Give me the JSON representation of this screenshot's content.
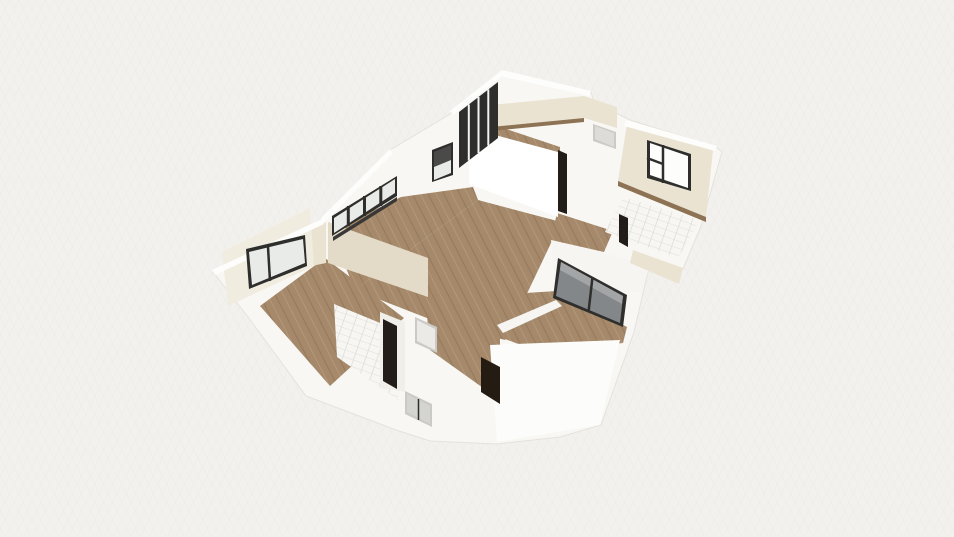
{
  "scene": {
    "canvas": {
      "width": 954,
      "height": 537,
      "view_label": "3d-floor-plan-view"
    },
    "palette": {
      "bg": "#f2f1ee",
      "gridLine": "#e7e6e2",
      "baseWhite": "#f8f7f4",
      "baseEdge": "#e4e2dc",
      "wallLight": "#f6f5f1",
      "wallBright": "#fcfcfa",
      "wallShade": "#f1efe9",
      "blockWhite": "#ffffff",
      "wallTop": "#fdfdfb",
      "cream": "#eae3d2",
      "creamDark": "#e3dbc7",
      "creamPale": "#f0ece0",
      "woodBase": "#a5896a",
      "woodDark": "#967a5d",
      "woodLight": "#b2977a",
      "woodTrim": "#8d7254",
      "tileBase": "#f7f6f3",
      "tileLine": "#d9d6cf",
      "frameDark": "#2e2e2c",
      "mullion": "#f4f4f1",
      "glassDark": "#4a4a48",
      "glassLight": "#e9ebe9",
      "glassWhite": "#fdfdfc",
      "glassMid": "#84878a",
      "glassHi": "#a3a5a7",
      "glassPale": "#d4d4d0",
      "sillDark": "#3a3836",
      "doorBrown": "#241c12",
      "doorDark": "#221d18",
      "doorGray": "#dddcd9",
      "doorGrayFrame": "#cbcac6",
      "doorWhite": "#eceae7"
    },
    "shapes": [
      {
        "name": "building-base",
        "fill": "baseWhite",
        "stroke": "baseEdge",
        "points": "502,71 591,92 594,102 630,120 716,147 722,152 701,226 683,269 652,260 648,272 634,332 601,425 560,437 497,444 430,441 396,430 306,396 248,317 213,272 322,220 330,212 390,150 452,113"
      },
      {
        "name": "room-a-floor",
        "fill": "wood",
        "points": "467,116 560,147 560,156 467,128"
      },
      {
        "name": "living-room-floor-upper",
        "fill": "wood",
        "points": "331,231 401,197 473,187 478,200 355,290"
      },
      {
        "name": "living-room-floor-center",
        "fill": "wood",
        "points": "355,290 478,200 561,222 505,340 432,320"
      },
      {
        "name": "hallway-floor",
        "fill": "wood",
        "points": "557,213 613,231 604,252 551,240"
      },
      {
        "name": "dining-area-floor",
        "fill": "wood",
        "points": "448,298 557,291 627,327 623,343 540,352 448,318"
      },
      {
        "name": "entry-floor",
        "fill": "wood",
        "points": "425,292 500,325 500,400 430,350"
      },
      {
        "name": "bedroom-left-floor",
        "fill": "wood",
        "points": "325,258 404,318 330,386 260,306"
      },
      {
        "name": "bathroom-left-floor",
        "fill": "tile",
        "points": "334,304 397,330 398,400 337,357"
      },
      {
        "name": "bathroom-right-floor",
        "fill": "tile",
        "points": "623,197 700,220 678,258 605,232"
      },
      {
        "name": "partition-entry-dining",
        "fill": "wallLight",
        "points": "497,325 556,300 562,306 503,333"
      },
      {
        "name": "right-wing-wall",
        "fill": "wallLight",
        "points": "551,240 650,265 642,292 556,289"
      },
      {
        "name": "south-wing-wall",
        "fill": "wallBright",
        "points": "490,345 620,340 600,425 497,442"
      },
      {
        "name": "bathroom-left-wall",
        "fill": "wallShade",
        "points": "380,312 405,322 405,392 380,388"
      },
      {
        "name": "closet-block",
        "fill": "blockWhite",
        "points": "469,128 558,152 558,217 469,184"
      },
      {
        "name": "room-a-north-wall",
        "fill": "cream",
        "points": "470,107 584,96 584,118 470,129"
      },
      {
        "name": "room-a-east-wall",
        "fill": "cream",
        "points": "584,96 617,107 617,128 584,118"
      },
      {
        "name": "corridor-wall-left",
        "fill": "creamDark",
        "points": "328,222 428,258 428,297 328,263"
      },
      {
        "name": "left-wing-corner-wall",
        "fill": "cream",
        "points": "300,233 326,222 326,263 302,268"
      },
      {
        "name": "bedroom-left-window-wall",
        "fill": "creamPale",
        "points": "222,252 310,208 314,266 228,306"
      },
      {
        "name": "bedroom-right-north-wall",
        "fill": "cream",
        "points": "627,124 713,150 706,217 618,181"
      },
      {
        "name": "dining-east-wall",
        "fill": "cream",
        "points": "633,250 683,268 679,284 630,263"
      },
      {
        "name": "room-a-wall-base-trim",
        "fill": "woodTrim",
        "points": "470,129 584,118 584,122 470,133"
      },
      {
        "name": "bedroom-right-wall-base-trim",
        "fill": "woodTrim",
        "points": "618,181 706,217 706,222 618,186"
      },
      {
        "name": "wall-top-room-a-west",
        "fill": "wallTop",
        "points": "450,111 502,70 505,74 453,115"
      },
      {
        "name": "wall-top-room-a-north",
        "fill": "wallTop",
        "points": "502,70 591,91 589,96 500,76"
      },
      {
        "name": "wall-top-bedroom-right",
        "fill": "wallTop",
        "points": "626,120 717,146 715,151 624,126"
      },
      {
        "name": "wall-top-left-wing",
        "fill": "wallTop",
        "points": "321,218 390,149 393,153 324,223"
      },
      {
        "name": "wall-top-bedroom-left",
        "fill": "wallTop",
        "points": "212,270 322,219 324,224 215,275"
      },
      {
        "name": "room-a-glazing-frame",
        "fill": "frameDark",
        "points": "459,112 498,82 498,138 459,168"
      },
      {
        "name": "room-a-glazing-mullion-1",
        "line": [
          468.8,
          104.5,
          468.8,
          160.5
        ],
        "w": 2,
        "fill": "mullion"
      },
      {
        "name": "room-a-glazing-mullion-2",
        "line": [
          478.5,
          97,
          478.5,
          153
        ],
        "w": 2,
        "fill": "mullion"
      },
      {
        "name": "room-a-glazing-mullion-3",
        "line": [
          488.3,
          89.5,
          488.3,
          145.5
        ],
        "w": 2,
        "fill": "mullion"
      },
      {
        "name": "west-window-frame",
        "fill": "frameDark",
        "points": "432,150 453,142 453,175 432,182"
      },
      {
        "name": "west-window-glass-upper",
        "fill": "glassDark",
        "points": "434,152 451,145 451,160 434,167"
      },
      {
        "name": "west-window-glass-lower",
        "fill": "glassLight",
        "points": "434,167 451,160 451,173 434,180"
      },
      {
        "name": "strip-windows-frame",
        "fill": "frameDark",
        "points": "332,216 397,176 397,196 332,236"
      },
      {
        "name": "strip-windows-glass",
        "fill": "glassLight",
        "points": "334,218 395,179 395,193 334,233"
      },
      {
        "name": "strip-windows-mullion-1",
        "line": [
          348.3,
          206,
          348.3,
          226
        ],
        "w": 3,
        "fill": "frameDark"
      },
      {
        "name": "strip-windows-mullion-2",
        "line": [
          364.5,
          196,
          364.5,
          216
        ],
        "w": 3,
        "fill": "frameDark"
      },
      {
        "name": "strip-windows-mullion-3",
        "line": [
          380.8,
          186,
          380.8,
          206
        ],
        "w": 3,
        "fill": "frameDark"
      },
      {
        "name": "strip-windows-sill",
        "fill": "sillDark",
        "points": "333,237 397,197 397,201 333,241"
      },
      {
        "name": "bedroom-left-window-frame",
        "fill": "frameDark",
        "points": "246,249 305,235 307,266 249,289"
      },
      {
        "name": "bedroom-left-window-glass",
        "fill": "glassLight",
        "points": "249,252 303,239 305,263 252,285"
      },
      {
        "name": "bedroom-left-window-mullion",
        "line": [
          268,
          247,
          270,
          281
        ],
        "w": 2.5,
        "fill": "frameDark"
      },
      {
        "name": "bedroom-right-window-frame",
        "fill": "frameDark",
        "points": "647,140 691,154 691,191 647,178"
      },
      {
        "name": "bedroom-right-window-glass",
        "fill": "glassWhite",
        "points": "650,143 688,156 688,188 650,175"
      },
      {
        "name": "bedroom-right-window-mullion-v",
        "line": [
          663,
          145,
          663,
          183
        ],
        "w": 2.5,
        "fill": "frameDark"
      },
      {
        "name": "bedroom-right-window-mullion-h",
        "line": [
          647,
          158,
          663,
          164
        ],
        "w": 2.5,
        "fill": "frameDark"
      },
      {
        "name": "patio-door-frame",
        "fill": "frameDark",
        "points": "558,258 627,295 623,327 553,298"
      },
      {
        "name": "patio-door-glass",
        "fill": "glassMid",
        "points": "561,262 623,296 620,323 556,296"
      },
      {
        "name": "patio-door-glass-highlight",
        "fill": "glassHi",
        "points": "561,262 623,296 622,304 560,270"
      },
      {
        "name": "patio-door-mullion",
        "line": [
          592.5,
          277,
          588.5,
          312
        ],
        "w": 2.5,
        "fill": "frameDark"
      },
      {
        "name": "hall-door-frame",
        "fill": "doorGrayFrame",
        "points": "593,124 616,132 616,149 593,141"
      },
      {
        "name": "hall-door-panel",
        "fill": "doorGray",
        "points": "595,126 614,133 614,147 595,139"
      },
      {
        "name": "closet-door-frame",
        "fill": "doorDark",
        "points": "558,150 567,154 567,214 558,211"
      },
      {
        "name": "entry-door",
        "fill": "doorBrown",
        "points": "481,357 500,367 500,404 481,392"
      },
      {
        "name": "bathroom-left-door",
        "fill": "doorDark",
        "points": "383,319 397,326 397,389 383,381"
      },
      {
        "name": "bathroom-right-door",
        "fill": "doorDark",
        "points": "619,214 628,218 628,247 619,242"
      },
      {
        "name": "interior-door-frame",
        "fill": "doorGrayFrame",
        "points": "415,317 437,327 437,353 415,343"
      },
      {
        "name": "interior-door-panel",
        "fill": "doorWhite",
        "points": "417,320 435,329 435,350 417,341"
      },
      {
        "name": "south-window-frame",
        "fill": "doorGrayFrame",
        "points": "405,391 432,404 432,427 405,414"
      },
      {
        "name": "south-window-glass",
        "fill": "glassPale",
        "points": "407,394 430,406 430,424 407,412"
      },
      {
        "name": "south-window-mullion",
        "line": [
          418.5,
          399,
          418.5,
          420
        ],
        "w": 1.5,
        "fill": "frameDark"
      }
    ]
  }
}
